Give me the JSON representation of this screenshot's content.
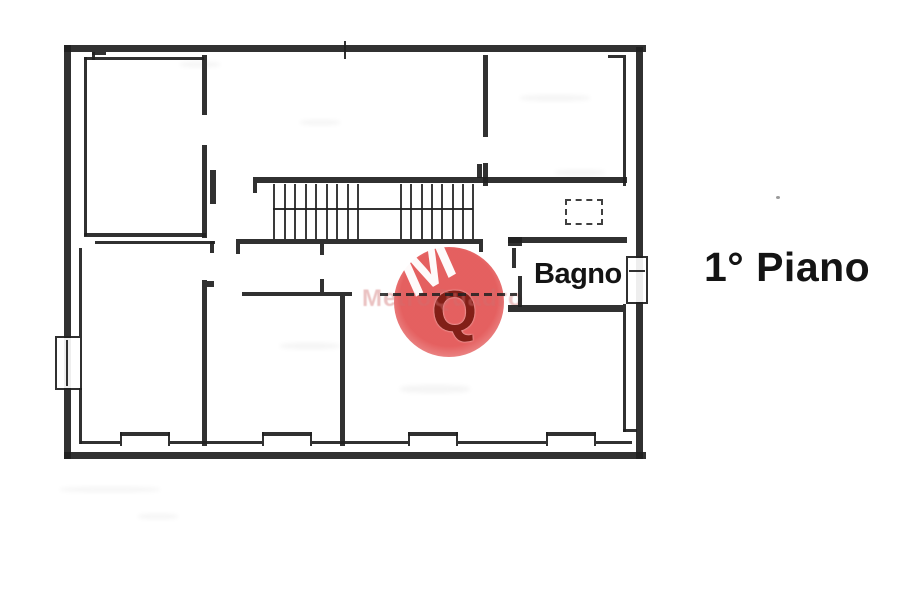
{
  "floor_label": "1° Piano",
  "room_label": "Bagno",
  "watermark": {
    "band_text": "MetroQuadro",
    "monogram_top": "M",
    "monogram_bottom": "Q",
    "circle_color": "#e14a4a",
    "monogram_top_color": "#ffffff",
    "monogram_bottom_color": "#7d1c14",
    "band_color": "#cf6f6f"
  },
  "colors": {
    "line": "#1f1f1f",
    "background": "#ffffff",
    "label": "#141414"
  },
  "plan": {
    "walls": [
      [
        64,
        45,
        582,
        7
      ],
      [
        64,
        45,
        7,
        414
      ],
      [
        64,
        452,
        582,
        7
      ],
      [
        636,
        47,
        7,
        412
      ],
      [
        80,
        441,
        552,
        3
      ],
      [
        84,
        57,
        120,
        3
      ],
      [
        84,
        57,
        3,
        179
      ],
      [
        92,
        52,
        3,
        8
      ],
      [
        92,
        52,
        14,
        3
      ],
      [
        202,
        55,
        5,
        60
      ],
      [
        202,
        145,
        5,
        93
      ],
      [
        210,
        170,
        6,
        34
      ],
      [
        84,
        233,
        122,
        4
      ],
      [
        95,
        241,
        120,
        3
      ],
      [
        210,
        241,
        4,
        12
      ],
      [
        79,
        248,
        3,
        88
      ],
      [
        79,
        388,
        3,
        56
      ],
      [
        202,
        280,
        5,
        166
      ],
      [
        207,
        281,
        7,
        6
      ],
      [
        242,
        292,
        110,
        4
      ],
      [
        320,
        279,
        4,
        13
      ],
      [
        340,
        296,
        5,
        150
      ],
      [
        253,
        177,
        374,
        6
      ],
      [
        477,
        164,
        5,
        14
      ],
      [
        253,
        183,
        4,
        10
      ],
      [
        236,
        239,
        247,
        5
      ],
      [
        236,
        244,
        4,
        10
      ],
      [
        320,
        244,
        4,
        11
      ],
      [
        479,
        244,
        4,
        8
      ],
      [
        273,
        208,
        200,
        2
      ],
      [
        483,
        55,
        5,
        82
      ],
      [
        483,
        163,
        5,
        23
      ],
      [
        608,
        55,
        18,
        3
      ],
      [
        623,
        58,
        3,
        128
      ],
      [
        508,
        237,
        119,
        6
      ],
      [
        508,
        237,
        14,
        9
      ],
      [
        512,
        248,
        4,
        20
      ],
      [
        518,
        276,
        4,
        31
      ],
      [
        508,
        305,
        115,
        7
      ],
      [
        623,
        304,
        3,
        128
      ],
      [
        623,
        429,
        14,
        3
      ],
      [
        344,
        41,
        2,
        18
      ]
    ],
    "stair_groups": [
      {
        "x": 273,
        "count": 9,
        "step": 10.5,
        "y": 184,
        "h": 55
      },
      {
        "x": 400,
        "count": 8,
        "step": 10.3,
        "y": 184,
        "h": 55
      }
    ],
    "windows_bottom": [
      {
        "x": 120,
        "w": 50
      },
      {
        "x": 262,
        "w": 50
      },
      {
        "x": 408,
        "w": 50
      },
      {
        "x": 546,
        "w": 50
      }
    ],
    "window_left": {
      "x": 55,
      "y": 336,
      "w": 27,
      "h": 54
    },
    "radiator_right": {
      "x": 626,
      "y": 256,
      "w": 22,
      "h": 48
    },
    "appliance_dashed": {
      "x": 565,
      "y": 199,
      "w": 38,
      "h": 26
    },
    "dashed_wall": {
      "x": 380,
      "y": 293,
      "w": 137,
      "h": 3
    },
    "dots": [
      [
        776,
        196,
        4,
        3
      ]
    ],
    "smudges": [
      [
        60,
        487,
        100,
        5
      ],
      [
        138,
        514,
        40,
        5
      ],
      [
        280,
        343,
        60,
        6
      ],
      [
        400,
        385,
        70,
        8
      ],
      [
        520,
        95,
        70,
        6
      ],
      [
        300,
        120,
        40,
        5
      ],
      [
        180,
        62,
        40,
        5
      ],
      [
        555,
        170,
        50,
        5
      ]
    ]
  }
}
